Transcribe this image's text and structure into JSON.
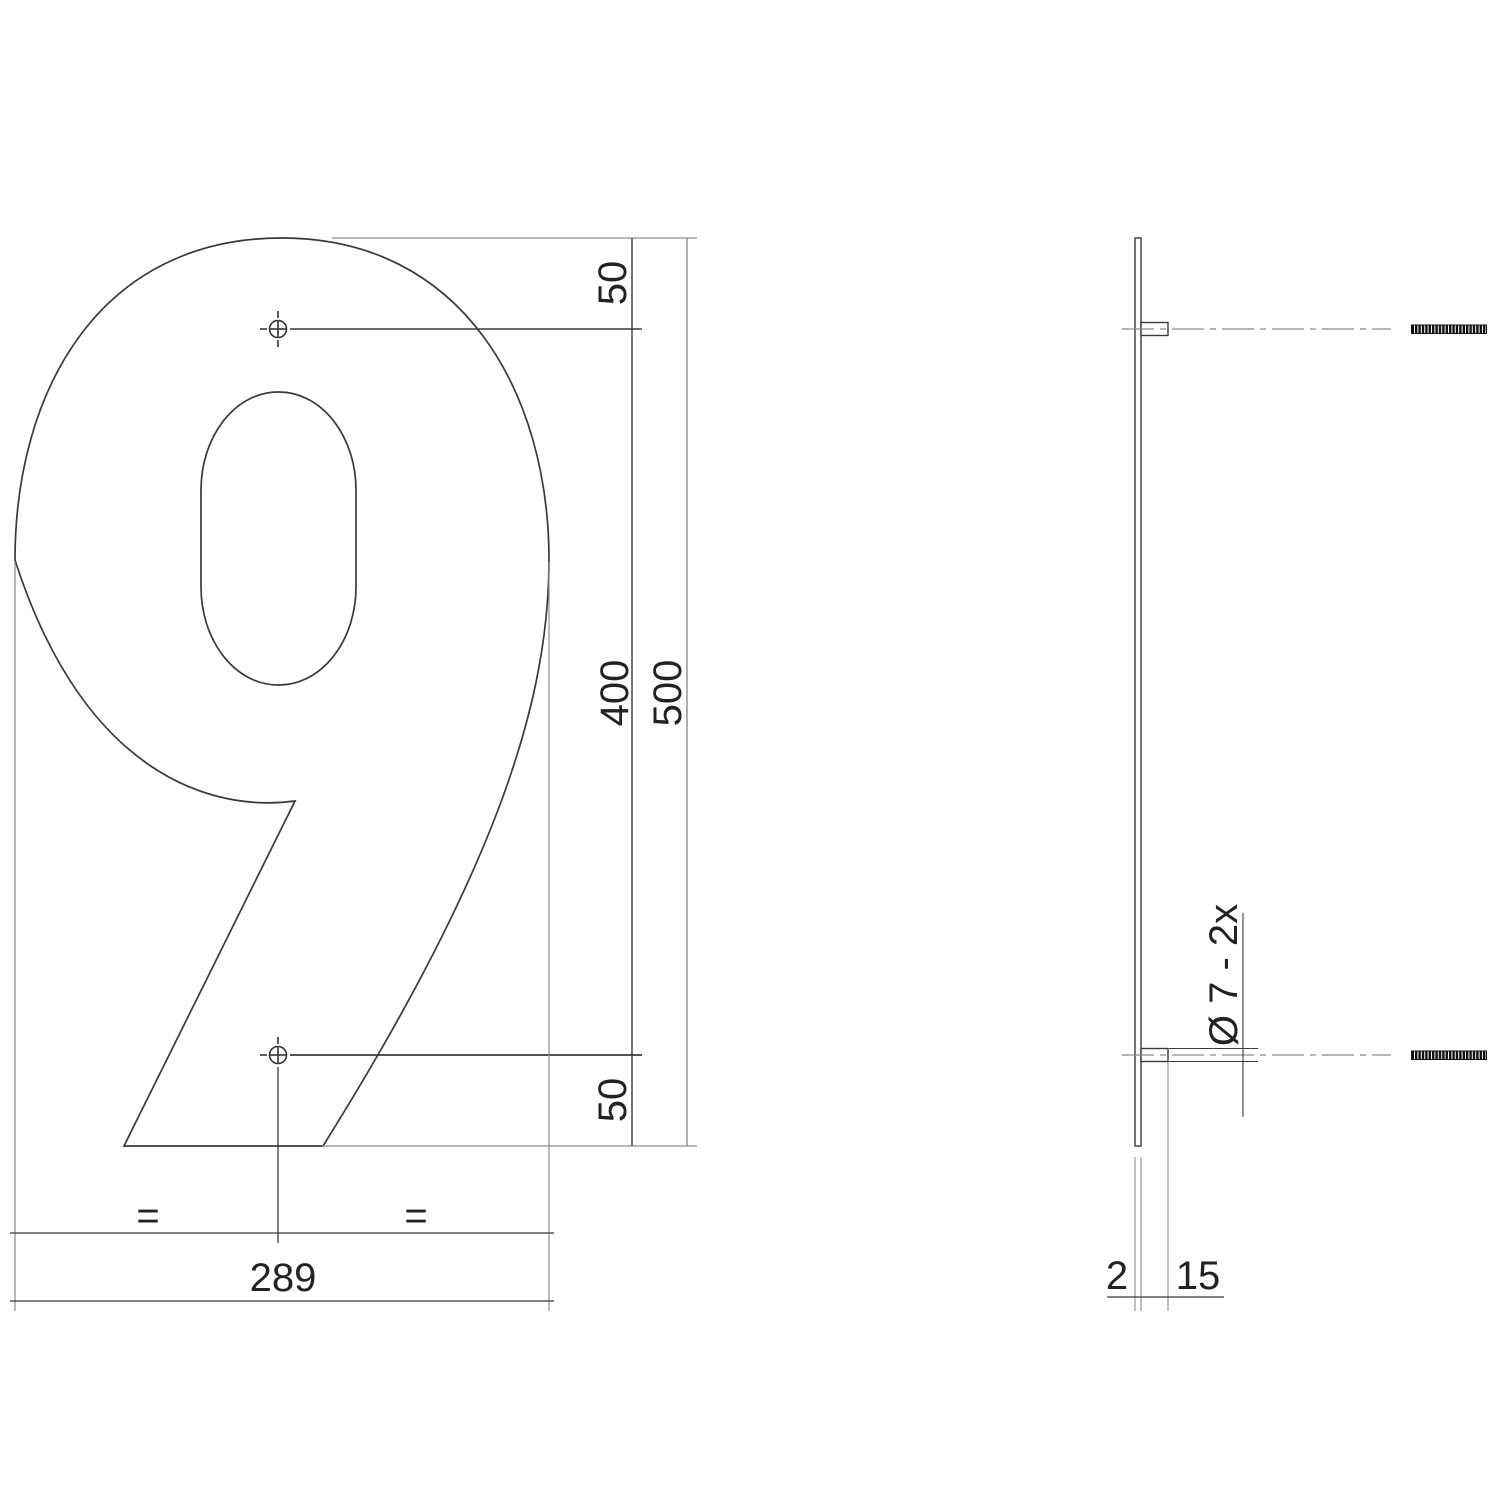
{
  "drawing": {
    "title": "House number 9 dimension drawing",
    "front_view": {
      "numeral": "9",
      "dims": {
        "top_hole_offset": "50",
        "hole_spacing": "400",
        "overall_height": "500",
        "bottom_hole_offset": "50",
        "overall_width": "289",
        "equal_left": "=",
        "equal_right": "="
      }
    },
    "side_view": {
      "dims": {
        "hole_note": "Ø 7 - 2x",
        "plate_thickness": "2",
        "stud_length": "15"
      }
    },
    "colors": {
      "line_dark": "#3a3a3a",
      "line_light": "#8c8c8c",
      "text": "#222222",
      "bolt_fill": "#121212"
    }
  }
}
